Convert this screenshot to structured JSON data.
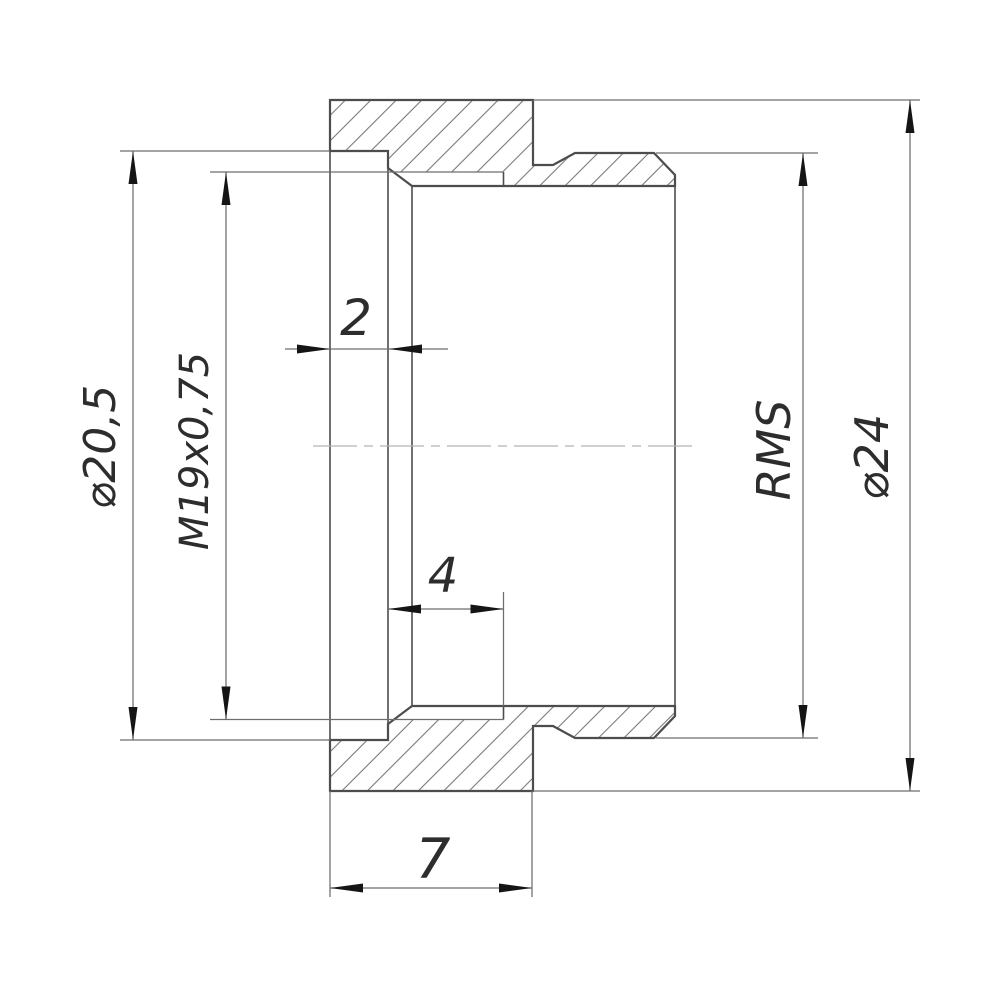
{
  "drawing": {
    "labels": {
      "recess_diameter": "⌀20,5",
      "thread_spec": "M19x0,75",
      "recess_depth": "2",
      "thread_length": "4",
      "flange_width": "7",
      "thread_right": "RMS",
      "outer_diameter": "⌀24"
    },
    "colors": {
      "background": "#ffffff",
      "outline": "#4d4d4d",
      "thin_line": "#6e6e6e",
      "hatch_line": "#7a7a7a",
      "centerline": "#b4b4b4",
      "text": "#2d2d2d",
      "arrowhead": "#151515"
    }
  }
}
